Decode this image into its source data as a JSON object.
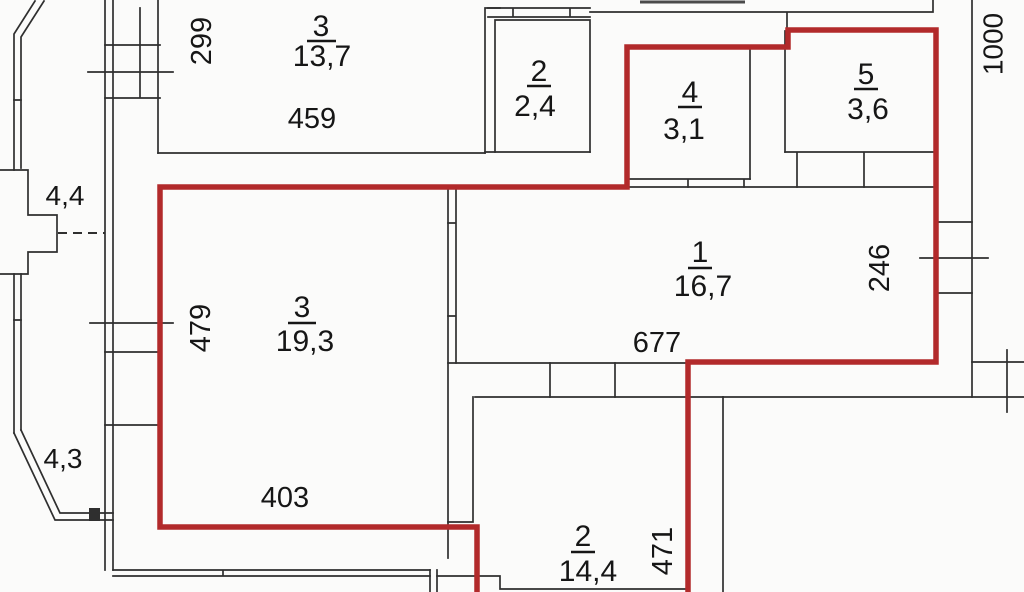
{
  "colors": {
    "outline": "#b22a2b",
    "wall": "#2f2f2f",
    "text": "#161616",
    "background": "#fbfbfa"
  },
  "rooms": [
    {
      "number": "3",
      "area": "13,7"
    },
    {
      "number": "2",
      "area": "2,4"
    },
    {
      "number": "4",
      "area": "3,1"
    },
    {
      "number": "5",
      "area": "3,6"
    },
    {
      "number": "1",
      "area": "16,7"
    },
    {
      "number": "3",
      "area": "19,3"
    },
    {
      "number": "2",
      "area": "14,4"
    }
  ],
  "dimensions": {
    "room3_top_height": "299",
    "room3_top_width": "459",
    "right_side": "1000",
    "balcony_top": "4,4",
    "living_height": "479",
    "living_width": "403",
    "balcony_bottom": "4,3",
    "hall_width": "677",
    "hall_side": "246",
    "kitchen_height": "471"
  }
}
